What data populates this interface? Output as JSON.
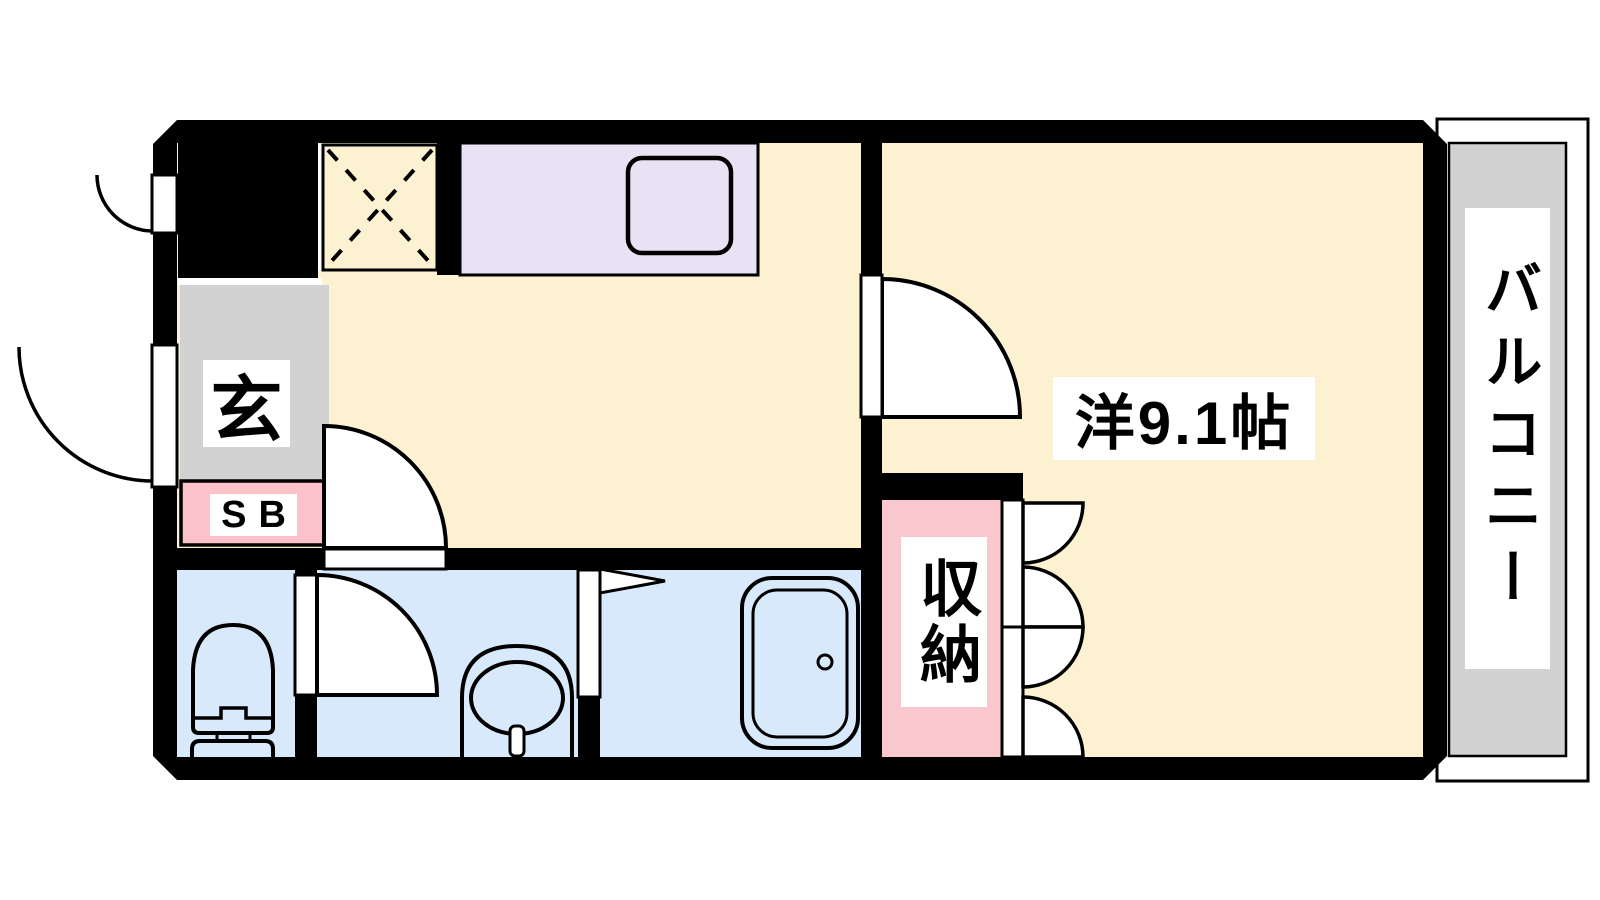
{
  "plan": {
    "type": "apartment-floor-plan",
    "labels": {
      "entrance": "玄",
      "shoe_box": "SB",
      "western_room": "洋9.1帖",
      "storage": "収納",
      "balcony": "バルコニー"
    },
    "colors": {
      "floor": "#FCF1D0",
      "counter": "#E9E1F4",
      "wet_area": "#D9E9FC",
      "shoe_box": "#FBC3C9",
      "storage": "#F9C8CE",
      "entrance": "#D2D2D2",
      "balcony": "#D2D2D2",
      "wall": "#000000"
    }
  }
}
